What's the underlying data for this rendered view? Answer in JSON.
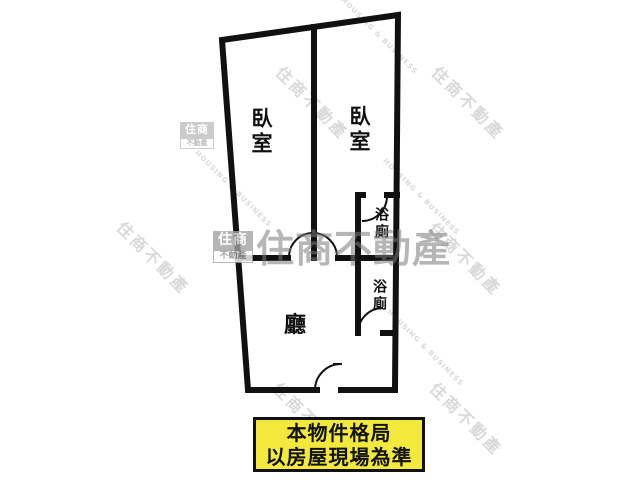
{
  "rooms": {
    "bedroom_left": "臥室",
    "bedroom_right": "臥室",
    "bath_upper": "浴廁",
    "bath_lower": "浴廁",
    "living": "廳"
  },
  "disclaimer": {
    "line1": "本物件格局",
    "line2": "以房屋現場為準"
  },
  "watermark": {
    "brand": "住商不動產",
    "logo_top": "住商",
    "logo_bottom": "不動產",
    "english": "HOUSING & BUSINESS"
  },
  "colors": {
    "wall": "#111111",
    "disclaimer_bg": "#f2e93c",
    "disclaimer_border": "#111111",
    "center_watermark_gray": "#7a7a7a",
    "tile_watermark_gray": "#d9d9d9"
  }
}
